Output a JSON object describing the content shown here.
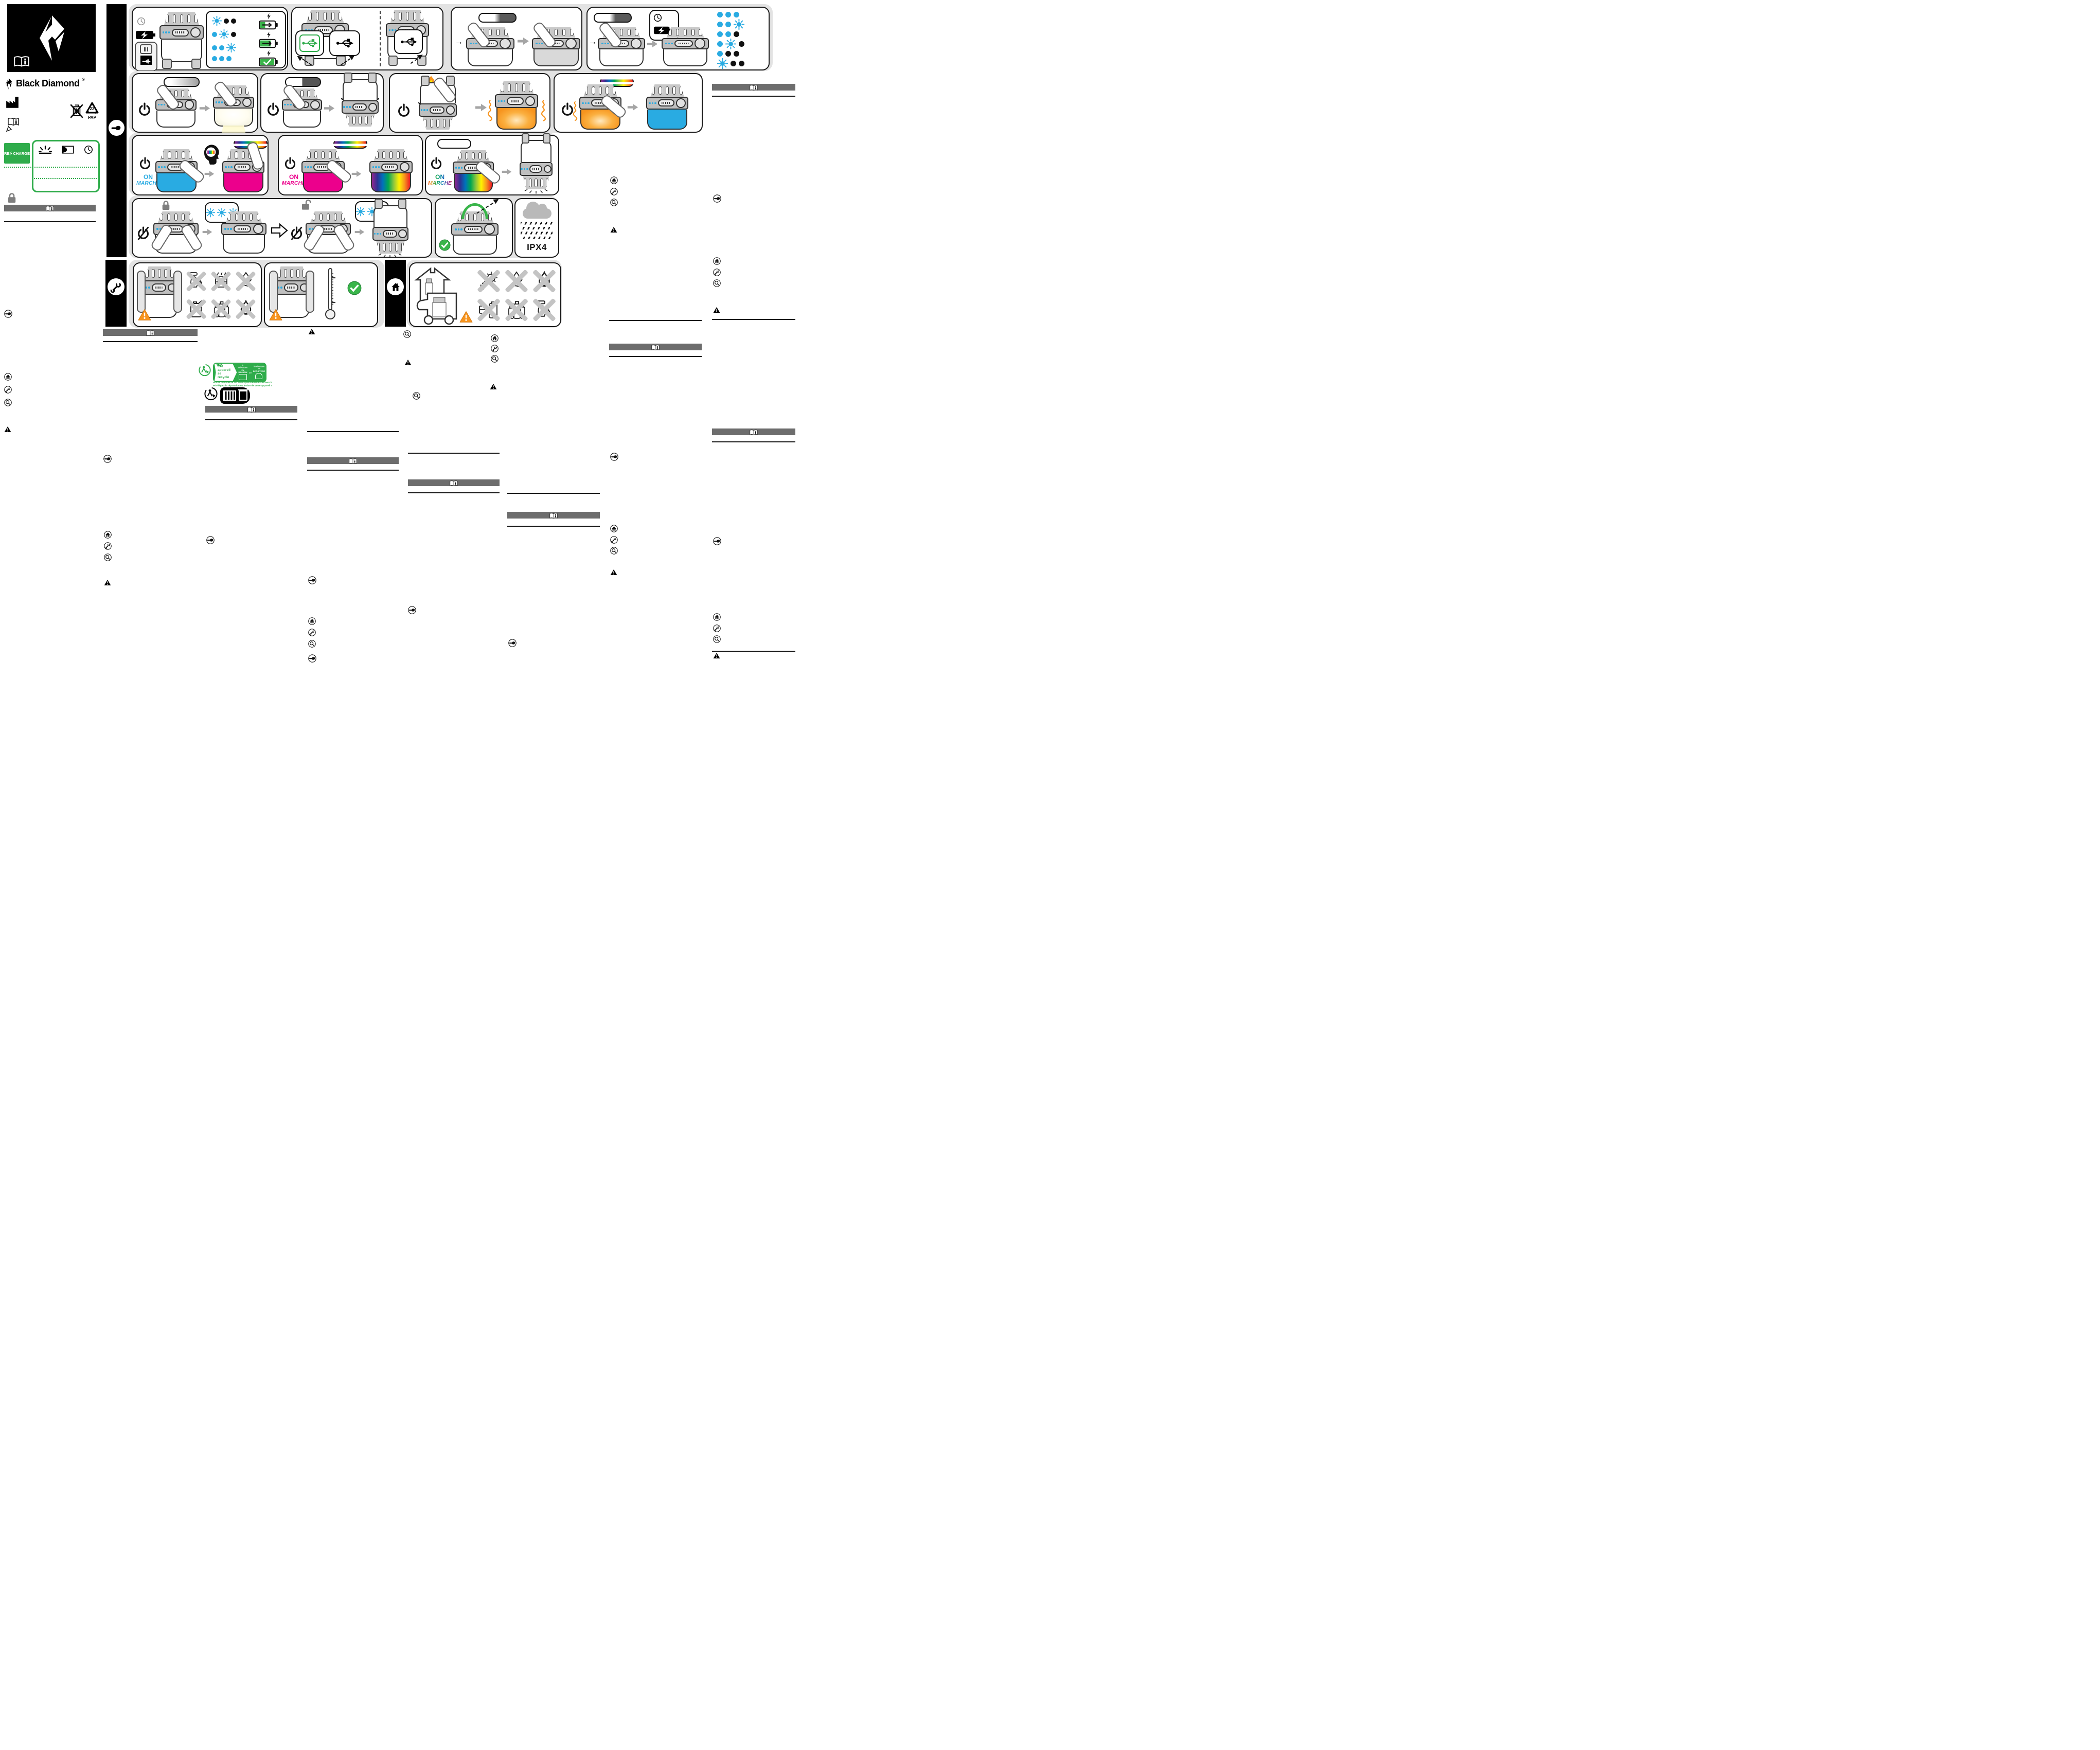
{
  "brand": {
    "wordmark": "Black Diamond",
    "registered": "®"
  },
  "labels": {
    "recharge_prefix": "RE",
    "recharge_suffix": "CHARGE",
    "pap_code": "22",
    "pap": "PAP",
    "ipx4": "IPX4",
    "on": "ON",
    "marche": "MARCHE"
  },
  "triman": {
    "flag": "FR",
    "title_line1": "Cet appareil",
    "title_line2": "se recycle",
    "option_store_l1": "À DÉPOSER",
    "option_store_l2": "EN MAGASIN",
    "or": "ou",
    "option_waste_l1": "À DÉPOSER",
    "option_waste_l2": "EN DÉCHÈTERIE",
    "note_line1": "Points de collecte sur www.quefairedemesdechets.fr",
    "note_line2": "Privilégiez la réparation ou le don de votre appareil !"
  },
  "colors": {
    "led_blue": "#29ABE2",
    "mode_pink": "#EC008C",
    "mode_orange": "#F7941E",
    "brand_green": "#39B54A",
    "triman_green": "#2FAC4B",
    "header_bar_gray": "#6D6D6D",
    "backdrop_gray": "#E3E3E3"
  },
  "figures": {
    "charging_indicator": {
      "rows": [
        [
          "blink",
          "off",
          "off"
        ],
        [
          "on",
          "blink",
          "off"
        ],
        [
          "on",
          "on",
          "blink"
        ],
        [
          "on",
          "on",
          "on"
        ]
      ],
      "battery_levels": [
        {
          "fill": 35,
          "status": "charging"
        },
        {
          "fill": 75,
          "status": "charging"
        },
        {
          "fill": 100,
          "status": "charged"
        }
      ]
    },
    "battery_check": {
      "rows": [
        [
          "on",
          "on",
          "on"
        ],
        [
          "on",
          "on",
          "blink"
        ],
        [
          "on",
          "on",
          "off"
        ],
        [
          "on",
          "blink",
          "off"
        ],
        [
          "on",
          "off",
          "off"
        ],
        [
          "blink",
          "off",
          "off"
        ]
      ]
    },
    "lockout_blink": {
      "rows": [
        [
          "blink",
          "blink",
          "blink"
        ],
        [
          "blink",
          "blink",
          "blink"
        ]
      ]
    }
  },
  "icons": {
    "book_info": "open-manual-with-i",
    "hand": "pointing-hand-circle",
    "house": "home-circle",
    "wrench": "service-circle",
    "magnifier": "inspect-circle",
    "warning": "warning-triangle",
    "power": "power-symbol",
    "usb": "usb-trident",
    "clock": "clock",
    "lock": "padlock",
    "recycle_bin_crossed": "no-trash-bin",
    "factory": "manufacturer",
    "triman": "triman-recycling"
  }
}
